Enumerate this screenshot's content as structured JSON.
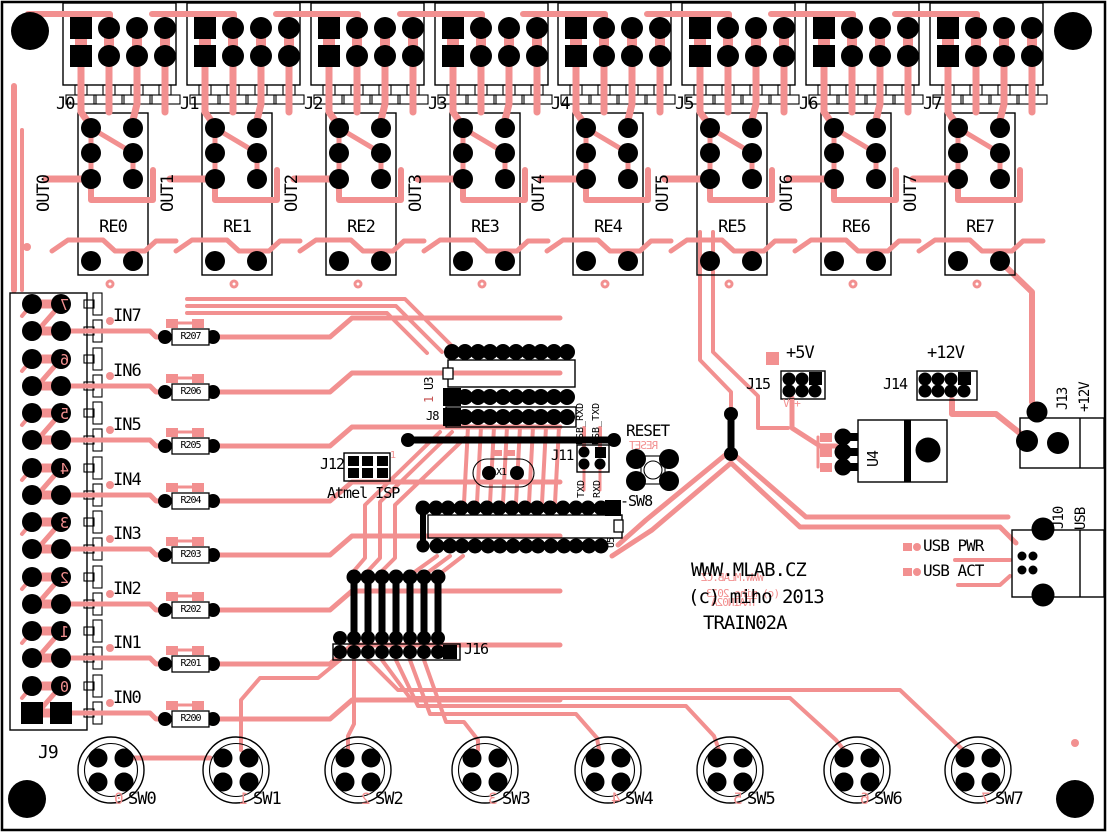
{
  "board": {
    "website": "WWW.MLAB.CZ",
    "copyright": "(c) miho 2013",
    "name": "TRAIN02A"
  },
  "colors": {
    "board_background": "#FFFFFF",
    "top_silk": "#000000",
    "copper_trace": "#F29090",
    "bottom_silk": "#F29090",
    "pads": "#000000"
  },
  "outputs": [
    {
      "connector": "J0",
      "signal": "OUT0",
      "relay": "RE0"
    },
    {
      "connector": "J1",
      "signal": "OUT1",
      "relay": "RE1"
    },
    {
      "connector": "J2",
      "signal": "OUT2",
      "relay": "RE2"
    },
    {
      "connector": "J3",
      "signal": "OUT3",
      "relay": "RE3"
    },
    {
      "connector": "J4",
      "signal": "OUT4",
      "relay": "RE4"
    },
    {
      "connector": "J5",
      "signal": "OUT5",
      "relay": "RE5"
    },
    {
      "connector": "J6",
      "signal": "OUT6",
      "relay": "RE6"
    },
    {
      "connector": "J7",
      "signal": "OUT7",
      "relay": "RE7"
    }
  ],
  "inputs": [
    {
      "signal": "IN7",
      "resistor": "R207",
      "bottom_digit": "7"
    },
    {
      "signal": "IN6",
      "resistor": "R206",
      "bottom_digit": "6"
    },
    {
      "signal": "IN5",
      "resistor": "R205",
      "bottom_digit": "5"
    },
    {
      "signal": "IN4",
      "resistor": "R204",
      "bottom_digit": "4"
    },
    {
      "signal": "IN3",
      "resistor": "R203",
      "bottom_digit": "3"
    },
    {
      "signal": "IN2",
      "resistor": "R202",
      "bottom_digit": "2"
    },
    {
      "signal": "IN1",
      "resistor": "R201",
      "bottom_digit": "1"
    },
    {
      "signal": "IN0",
      "resistor": "R200",
      "bottom_digit": "0"
    }
  ],
  "input_connector": "J9",
  "switches": [
    {
      "label": "SW0",
      "bottom_digit": "0"
    },
    {
      "label": "SW1",
      "bottom_digit": "1"
    },
    {
      "label": "SW2",
      "bottom_digit": "2"
    },
    {
      "label": "SW3",
      "bottom_digit": "3"
    },
    {
      "label": "SW4",
      "bottom_digit": "4"
    },
    {
      "label": "SW5",
      "bottom_digit": "5"
    },
    {
      "label": "SW6",
      "bottom_digit": "6"
    },
    {
      "label": "SW7",
      "bottom_digit": "7"
    }
  ],
  "ic_area": {
    "u3": "U3",
    "u3_pin1": "1",
    "j8": "J8",
    "j12": "J12",
    "j12_pin1": "1",
    "isp_note": "Atmel ISP",
    "x1": "X1",
    "j11": "J11",
    "usb_rxd": "USB_RXD",
    "usb_txd": "USB_TXD",
    "txd": "TXD",
    "rxd": "RXD",
    "reset": "RESET",
    "sw8": "-SW8",
    "u5": "U5",
    "j16": "J16"
  },
  "power": {
    "plus5v": "+5V",
    "j15": "J15",
    "plus12v": "+12V",
    "j14": "J14",
    "u4": "U4",
    "j13": "J13",
    "j13_voltage": "+12V",
    "j10": "J10",
    "j10_type": "USB",
    "usb_pwr": "USB PWR",
    "usb_act": "USB ACT"
  },
  "bottom_silk": {
    "website": "WWW.MLAB.CZ",
    "copyright": "(c) miho 2013",
    "name": "TRAIN02A",
    "reset": "RESET",
    "plus5v": "+5V"
  }
}
